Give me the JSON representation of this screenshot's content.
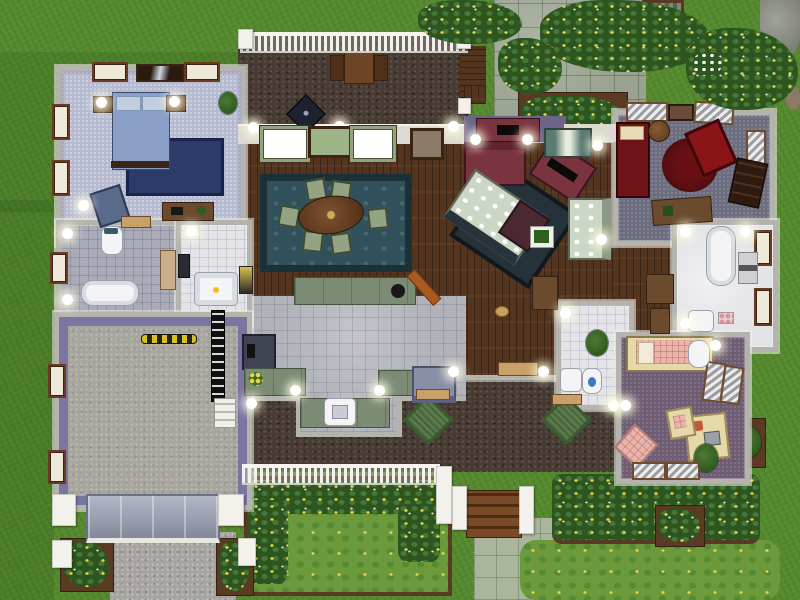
{
  "palette": {
    "grass": "#568a2f",
    "lawn": "#6b9a3d",
    "bushGreen": "#2c5520",
    "flowerYellow": "#e8d44a",
    "soil": "#5a3a22",
    "wall": "#b5b3ad",
    "wallWhite": "#ded9d1",
    "wallPurple": "#6e6488",
    "garageTrim": "#7b75a2",
    "wood": "#53341e",
    "woodTrim": "#a85a20",
    "tileGray": "#b1b2ba",
    "tileWhite": "#e3e3e8",
    "tileBlue": "#a9abb8",
    "carpetBlue": "#b6bad0",
    "carpetSlate": "#6d6d80",
    "carpetPurple": "#6d5c72",
    "garageFloor": "#a8a59e",
    "driveway": "#a5a4a0",
    "pebble": "#473b33",
    "stonePatio": "#99a28f",
    "stoneWalk": "#a9b69b",
    "rugNavy": "#2c3b6a",
    "rugTeal": "#30505c",
    "rugDark": "#26323a",
    "rugRed": "#5a0e12",
    "counterGreen": "#7c8b74",
    "maroon": "#7a3440",
    "bedBlue": "#8aa0c8",
    "bedRed": "#6e1418",
    "bedPink": "#e8b4ac",
    "sofaFloral": "#ccd6c4",
    "furnWood": "#6b4a2e",
    "fixture": "#f4f4f6",
    "doormat": "#5a7a4a"
  },
  "scene": {
    "description": "Top-down floor plan view of a furnished suburban house with lawn, deck, porch and gardens",
    "rooms": [
      {
        "id": "master-bedroom",
        "label": "Blue bedroom",
        "floor": "light blue carpet",
        "items": [
          "double bed",
          "two nightstands with lamps",
          "navy rug",
          "desk",
          "blue armchair",
          "floor lamp",
          "potted plant",
          "mirror",
          "windows"
        ]
      },
      {
        "id": "main-bathroom",
        "label": "Main bathroom",
        "floor": "blue-gray tile",
        "items": [
          "toilet",
          "clawfoot bathtub",
          "vanity counter",
          "window"
        ]
      },
      {
        "id": "shower-room",
        "label": "Shower room",
        "floor": "white tile",
        "items": [
          "shower tub with duck",
          "medicine cabinet"
        ]
      },
      {
        "id": "garage",
        "label": "Garage",
        "floor": "concrete",
        "items": [
          "sectional garage door",
          "yellow-black parking strip",
          "wall ladder",
          "side steps",
          "windows"
        ]
      },
      {
        "id": "back-deck",
        "label": "Back deck",
        "floor": "dark pebble stone",
        "items": [
          "picnic table with benches",
          "barbecue grill",
          "white railing",
          "wood steps"
        ]
      },
      {
        "id": "dining-room",
        "label": "Dining room",
        "floor": "dark hardwood",
        "items": [
          "oval dining table",
          "six floral chairs",
          "teal patterned rug",
          "green curtain windows",
          "wall picture"
        ]
      },
      {
        "id": "kitchen",
        "label": "Kitchen",
        "floor": "gray tile",
        "items": [
          "island bar with sink",
          "stove",
          "green counters",
          "counter sink",
          "flower vase",
          "gray loveseat",
          "highchair"
        ]
      },
      {
        "id": "living-room",
        "label": "Living room",
        "floor": "dark hardwood",
        "items": [
          "fireplace",
          "maroon loveseat",
          "tv cabinet",
          "floral sofa",
          "dark rug",
          "coffee table",
          "floral loveseat",
          "framed plant"
        ]
      },
      {
        "id": "red-bedroom",
        "label": "Red bedroom",
        "floor": "slate carpet",
        "items": [
          "single bed",
          "round red rug",
          "red armchair",
          "bookshelf",
          "desk",
          "round side table",
          "striped curtains"
        ]
      },
      {
        "id": "right-bathroom",
        "label": "Hall bathroom",
        "floor": "white tile",
        "items": [
          "clawfoot bathtub",
          "sink",
          "windows",
          "wall art",
          "perfume tray"
        ]
      },
      {
        "id": "powder-room",
        "label": "Powder room",
        "floor": "white tile",
        "items": [
          "sink",
          "toilet",
          "potted plant"
        ]
      },
      {
        "id": "pink-bedroom",
        "label": "Pink bedroom",
        "floor": "purple carpet",
        "items": [
          "single bed",
          "bassinet",
          "cream desk with computer",
          "desk chair",
          "pink floor cushion",
          "potted plant",
          "striped blinds"
        ]
      },
      {
        "id": "front-porch",
        "label": "Front porch",
        "floor": "dark pebble stone",
        "items": [
          "two green doormats",
          "white railing",
          "entry doors",
          "wood entry steps",
          "pet bowl"
        ]
      },
      {
        "id": "yard",
        "label": "Yard",
        "floor": "grass",
        "items": [
          "stone patio",
          "garden bench",
          "flower beds with yellow flowers",
          "stone walkway",
          "gravel driveway",
          "planters",
          "shrubs",
          "rocks"
        ]
      }
    ]
  }
}
